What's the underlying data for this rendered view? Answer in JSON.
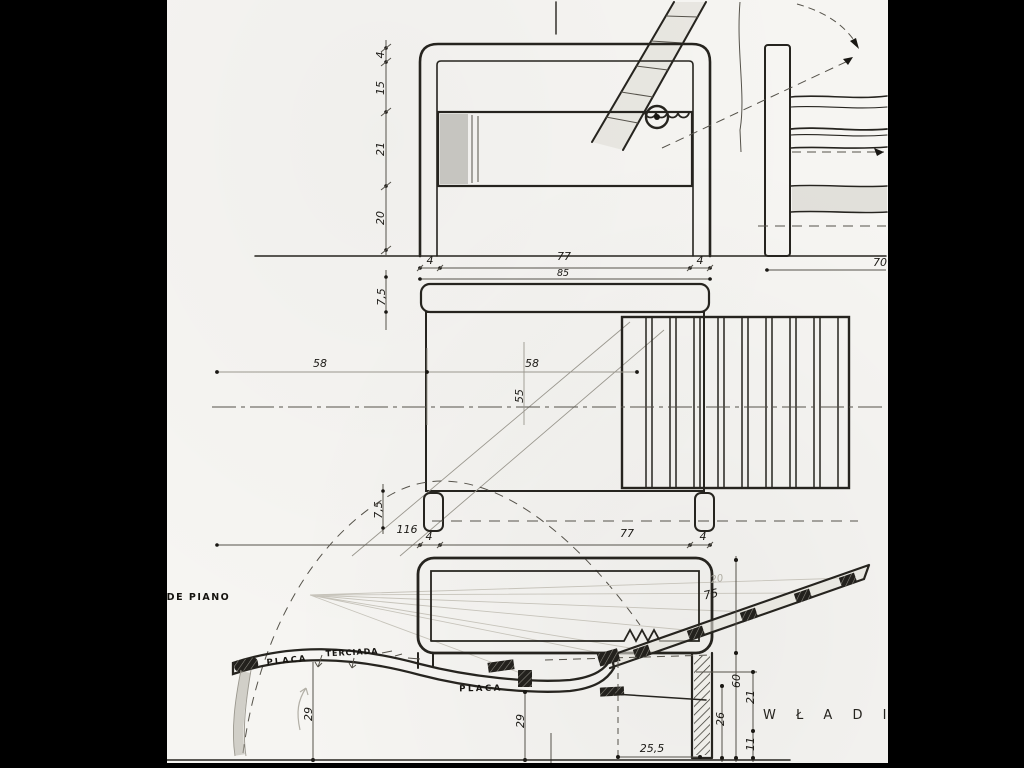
{
  "colors": {
    "paper": "#f6f5f2",
    "ink": "#26241f",
    "pencil": "#b2afa6",
    "background": "#000000"
  },
  "ann": {
    "fichas": "FICHAS DE PIANO",
    "placa_curve": "PLACA",
    "terciada": "TERCIADA",
    "placa_flat": "PLACA",
    "signature": "W Ł A D I M"
  },
  "dim": {
    "f4": "4",
    "f15": "15",
    "f21": "21",
    "f20": "20",
    "fw4l": "4",
    "fw77": "77",
    "fw4r": "4",
    "fw85": "85",
    "s70": "70",
    "p75a": "7,5",
    "p58l": "58",
    "p58r": "58",
    "p55": "55",
    "p75b": "7,5",
    "p116": "116",
    "p4l": "4",
    "p77": "77",
    "p4r": "4",
    "e20": "20",
    "e75": "75",
    "e60": "60",
    "e21": "21",
    "e26": "26",
    "e11": "11",
    "e29a": "29",
    "e29b": "29",
    "e255": "25,5"
  }
}
